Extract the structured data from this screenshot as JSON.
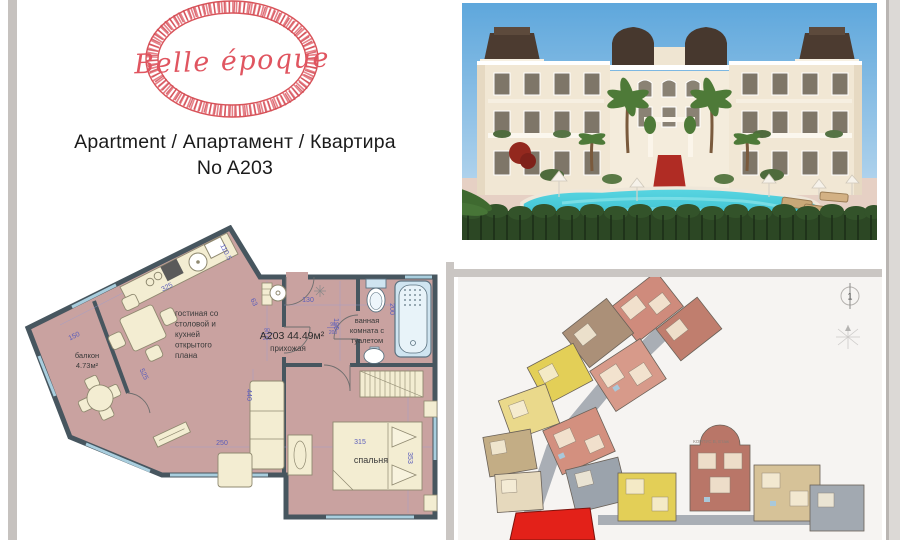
{
  "logo": {
    "brand": "Belle époque"
  },
  "header": {
    "title": "Apartment / Апартамент / Квартира",
    "unit": "No A203"
  },
  "floorplan": {
    "unit_area_label": "A203 44.49м²",
    "rooms": {
      "living_lines": [
        "гостиная со",
        "столовой и",
        "кухней",
        "открытого",
        "плана"
      ],
      "balcony_name": "балкон",
      "balcony_area": "4.73м²",
      "hall": "прихожая",
      "bath_lines": [
        "ванная",
        "комната с",
        "туалетом"
      ],
      "bedroom": "спальня"
    },
    "dims": {
      "d325": "325",
      "d1105": "110.5",
      "d150": "150",
      "d525": "525",
      "d63": "63",
      "d130": "130",
      "d200v": "200",
      "d190": "190",
      "d90a": "90",
      "d200a": "200",
      "d90b": "90",
      "d200b": "200",
      "d440": "440",
      "d250": "250",
      "d315": "315",
      "d353": "353"
    }
  },
  "siteplan": {
    "block_label": "КОРПУС В, Етаж",
    "compass_label": "1"
  },
  "colors": {
    "brand_red": "#d8545a",
    "plan_wall": "#47565f",
    "plan_room": "#c9a2a0",
    "plan_furniture": "#f3edd2",
    "plan_fixture": "#cfe4f0",
    "dim_blue": "#5a5dbb",
    "pool": "#3fc9d6",
    "sky": "#5ea7dc",
    "hedge": "#2c4724",
    "unit_highlight": "#e32119"
  }
}
